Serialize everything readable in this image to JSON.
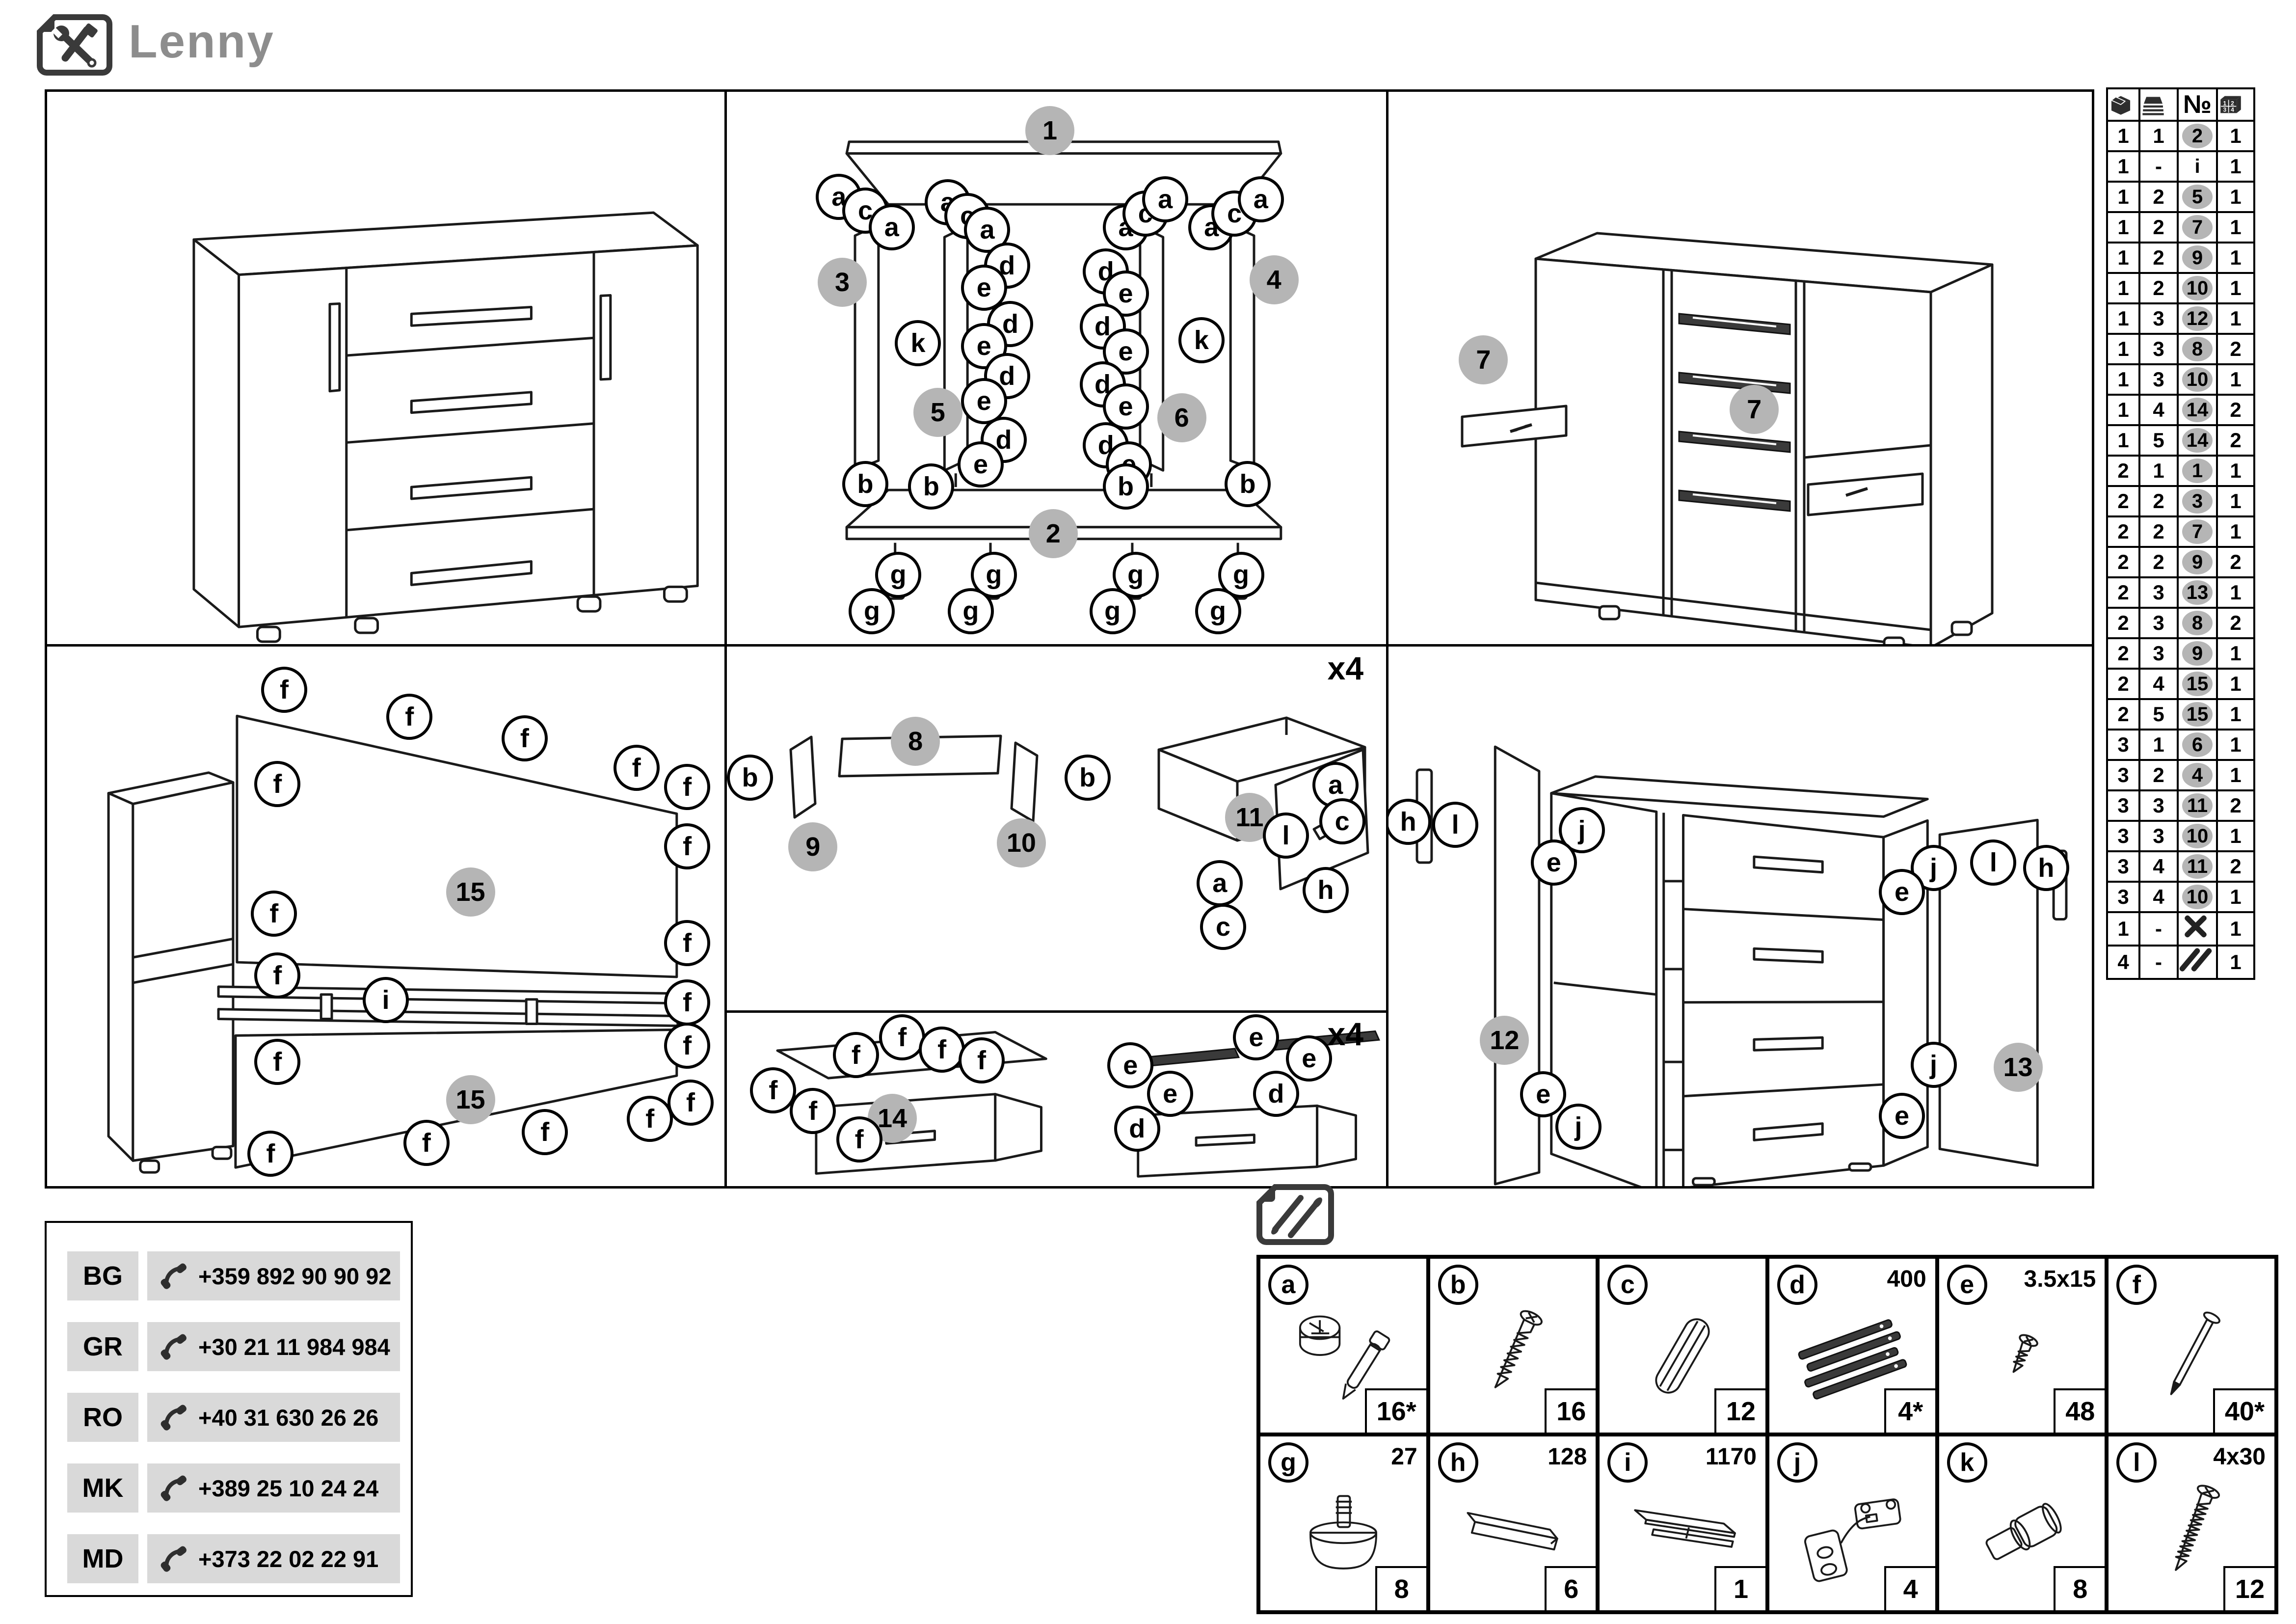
{
  "title": "Lenny",
  "colors": {
    "step_circle": "#b5b5b5",
    "title_gray": "#8d8d8d",
    "phone_bg": "#d9d9d9",
    "ink": "#1a1a1a"
  },
  "parts_table": {
    "number_header": "№",
    "header_icons": [
      "package-icon",
      "sheets-icon",
      "number-header",
      "carton-icon"
    ],
    "rows": [
      {
        "box": "1",
        "sheet": "1",
        "num": "2",
        "numstyle": "circled",
        "qty": "1"
      },
      {
        "box": "1",
        "sheet": "-",
        "num": "i",
        "numstyle": "plain",
        "qty": "1"
      },
      {
        "box": "1",
        "sheet": "2",
        "num": "5",
        "numstyle": "circled",
        "qty": "1"
      },
      {
        "box": "1",
        "sheet": "2",
        "num": "7",
        "numstyle": "circled",
        "qty": "1"
      },
      {
        "box": "1",
        "sheet": "2",
        "num": "9",
        "numstyle": "circled",
        "qty": "1"
      },
      {
        "box": "1",
        "sheet": "2",
        "num": "10",
        "numstyle": "circled",
        "qty": "1"
      },
      {
        "box": "1",
        "sheet": "3",
        "num": "12",
        "numstyle": "circled",
        "qty": "1"
      },
      {
        "box": "1",
        "sheet": "3",
        "num": "8",
        "numstyle": "circled",
        "qty": "2"
      },
      {
        "box": "1",
        "sheet": "3",
        "num": "10",
        "numstyle": "circled",
        "qty": "1"
      },
      {
        "box": "1",
        "sheet": "4",
        "num": "14",
        "numstyle": "circled",
        "qty": "2"
      },
      {
        "box": "1",
        "sheet": "5",
        "num": "14",
        "numstyle": "circled",
        "qty": "2"
      },
      {
        "box": "2",
        "sheet": "1",
        "num": "1",
        "numstyle": "circled",
        "qty": "1"
      },
      {
        "box": "2",
        "sheet": "2",
        "num": "3",
        "numstyle": "circled",
        "qty": "1"
      },
      {
        "box": "2",
        "sheet": "2",
        "num": "7",
        "numstyle": "circled",
        "qty": "1"
      },
      {
        "box": "2",
        "sheet": "2",
        "num": "9",
        "numstyle": "circled",
        "qty": "2"
      },
      {
        "box": "2",
        "sheet": "3",
        "num": "13",
        "numstyle": "circled",
        "qty": "1"
      },
      {
        "box": "2",
        "sheet": "3",
        "num": "8",
        "numstyle": "circled",
        "qty": "2"
      },
      {
        "box": "2",
        "sheet": "3",
        "num": "9",
        "numstyle": "circled",
        "qty": "1"
      },
      {
        "box": "2",
        "sheet": "4",
        "num": "15",
        "numstyle": "circled",
        "qty": "1"
      },
      {
        "box": "2",
        "sheet": "5",
        "num": "15",
        "numstyle": "circled",
        "qty": "1"
      },
      {
        "box": "3",
        "sheet": "1",
        "num": "6",
        "numstyle": "circled",
        "qty": "1"
      },
      {
        "box": "3",
        "sheet": "2",
        "num": "4",
        "numstyle": "circled",
        "qty": "1"
      },
      {
        "box": "3",
        "sheet": "3",
        "num": "11",
        "numstyle": "circled",
        "qty": "2"
      },
      {
        "box": "3",
        "sheet": "3",
        "num": "10",
        "numstyle": "circled",
        "qty": "1"
      },
      {
        "box": "3",
        "sheet": "4",
        "num": "11",
        "numstyle": "circled",
        "qty": "2"
      },
      {
        "box": "3",
        "sheet": "4",
        "num": "10",
        "numstyle": "circled",
        "qty": "1"
      },
      {
        "box": "1",
        "sheet": "-",
        "num": "",
        "numstyle": "tools",
        "qty": "1"
      },
      {
        "box": "4",
        "sheet": "-",
        "num": "",
        "numstyle": "screws",
        "qty": "1"
      }
    ]
  },
  "phones": {
    "rows": [
      {
        "code": "BG",
        "number": "+359 892 90 90 92"
      },
      {
        "code": "GR",
        "number": "+30 21 11 984 984"
      },
      {
        "code": "RO",
        "number": "+40 31 630 26 26"
      },
      {
        "code": "MK",
        "number": "+389 25 10 24 24"
      },
      {
        "code": "MD",
        "number": "+373 22 02 22 91"
      }
    ]
  },
  "hardware": {
    "cells": [
      {
        "letter": "a",
        "spec": "",
        "qty": "16*",
        "icon": "cam-lock-icon"
      },
      {
        "letter": "b",
        "spec": "",
        "qty": "16",
        "icon": "screw-icon"
      },
      {
        "letter": "c",
        "spec": "",
        "qty": "12",
        "icon": "dowel-icon"
      },
      {
        "letter": "d",
        "spec": "400",
        "qty": "4*",
        "icon": "drawer-slides-icon"
      },
      {
        "letter": "e",
        "spec": "3.5x15",
        "qty": "48",
        "icon": "small-screw-icon"
      },
      {
        "letter": "f",
        "spec": "",
        "qty": "40*",
        "icon": "nail-icon"
      },
      {
        "letter": "g",
        "spec": "27",
        "qty": "8",
        "icon": "foot-icon"
      },
      {
        "letter": "h",
        "spec": "128",
        "qty": "6",
        "icon": "profile-strip-icon"
      },
      {
        "letter": "i",
        "spec": "1170",
        "qty": "1",
        "icon": "h-profile-icon"
      },
      {
        "letter": "j",
        "spec": "",
        "qty": "4",
        "icon": "hinge-icon"
      },
      {
        "letter": "k",
        "spec": "",
        "qty": "8",
        "icon": "shelf-pin-icon"
      },
      {
        "letter": "l",
        "spec": "4x30",
        "qty": "12",
        "icon": "long-screw-icon"
      }
    ]
  },
  "panels": {
    "assembled": {
      "callouts": []
    },
    "exploded": {
      "callouts": [
        {
          "t": "step",
          "label": "1",
          "x": 49,
          "y": 7
        },
        {
          "t": "step",
          "label": "2",
          "x": 49.5,
          "y": 80
        },
        {
          "t": "step",
          "label": "3",
          "x": 17.5,
          "y": 34.5
        },
        {
          "t": "step",
          "label": "4",
          "x": 83,
          "y": 34
        },
        {
          "t": "step",
          "label": "5",
          "x": 32,
          "y": 58
        },
        {
          "t": "step",
          "label": "6",
          "x": 69,
          "y": 59
        },
        {
          "t": "part",
          "label": "a",
          "x": 17,
          "y": 19
        },
        {
          "t": "part",
          "label": "c",
          "x": 21,
          "y": 21.5
        },
        {
          "t": "part",
          "label": "a",
          "x": 25,
          "y": 24.5
        },
        {
          "t": "part",
          "label": "a",
          "x": 33.5,
          "y": 20
        },
        {
          "t": "part",
          "label": "c",
          "x": 36.5,
          "y": 22.5
        },
        {
          "t": "part",
          "label": "a",
          "x": 39.5,
          "y": 25
        },
        {
          "t": "part",
          "label": "a",
          "x": 60.5,
          "y": 24.5
        },
        {
          "t": "part",
          "label": "c",
          "x": 63.5,
          "y": 22
        },
        {
          "t": "part",
          "label": "a",
          "x": 66.5,
          "y": 19.5
        },
        {
          "t": "part",
          "label": "a",
          "x": 73.5,
          "y": 24.5
        },
        {
          "t": "part",
          "label": "c",
          "x": 77,
          "y": 22
        },
        {
          "t": "part",
          "label": "a",
          "x": 81,
          "y": 19.5
        },
        {
          "t": "part",
          "label": "d",
          "x": 42.5,
          "y": 31.5
        },
        {
          "t": "part",
          "label": "e",
          "x": 39,
          "y": 35.5
        },
        {
          "t": "part",
          "label": "d",
          "x": 43,
          "y": 42
        },
        {
          "t": "part",
          "label": "e",
          "x": 39,
          "y": 46
        },
        {
          "t": "part",
          "label": "d",
          "x": 42.5,
          "y": 51.5
        },
        {
          "t": "part",
          "label": "e",
          "x": 39,
          "y": 56
        },
        {
          "t": "part",
          "label": "d",
          "x": 42,
          "y": 63
        },
        {
          "t": "part",
          "label": "e",
          "x": 38.5,
          "y": 67.5
        },
        {
          "t": "part",
          "label": "d",
          "x": 57.5,
          "y": 32.5
        },
        {
          "t": "part",
          "label": "e",
          "x": 60.5,
          "y": 36.5
        },
        {
          "t": "part",
          "label": "d",
          "x": 57,
          "y": 42.5
        },
        {
          "t": "part",
          "label": "e",
          "x": 60.5,
          "y": 47
        },
        {
          "t": "part",
          "label": "d",
          "x": 57,
          "y": 53
        },
        {
          "t": "part",
          "label": "e",
          "x": 60.5,
          "y": 57
        },
        {
          "t": "part",
          "label": "d",
          "x": 57.5,
          "y": 64
        },
        {
          "t": "part",
          "label": "e",
          "x": 61,
          "y": 67.5
        },
        {
          "t": "part",
          "label": "k",
          "x": 29,
          "y": 45.5
        },
        {
          "t": "part",
          "label": "k",
          "x": 72,
          "y": 45
        },
        {
          "t": "part",
          "label": "b",
          "x": 21,
          "y": 71
        },
        {
          "t": "part",
          "label": "b",
          "x": 31,
          "y": 71.5
        },
        {
          "t": "part",
          "label": "b",
          "x": 60.5,
          "y": 71.5
        },
        {
          "t": "part",
          "label": "b",
          "x": 79,
          "y": 71
        },
        {
          "t": "part",
          "label": "g",
          "x": 26,
          "y": 87.5
        },
        {
          "t": "part",
          "label": "g",
          "x": 22,
          "y": 94
        },
        {
          "t": "part",
          "label": "g",
          "x": 40.5,
          "y": 87.5
        },
        {
          "t": "part",
          "label": "g",
          "x": 37,
          "y": 94
        },
        {
          "t": "part",
          "label": "g",
          "x": 62,
          "y": 87.5
        },
        {
          "t": "part",
          "label": "g",
          "x": 58.5,
          "y": 94
        },
        {
          "t": "part",
          "label": "g",
          "x": 78,
          "y": 87.5
        },
        {
          "t": "part",
          "label": "g",
          "x": 74.5,
          "y": 94
        }
      ]
    },
    "carcass": {
      "callouts": [
        {
          "t": "step",
          "label": "7",
          "x": 13.5,
          "y": 48.5
        },
        {
          "t": "step",
          "label": "7",
          "x": 52,
          "y": 57.5
        }
      ]
    },
    "back": {
      "callouts": [
        {
          "t": "step",
          "label": "15",
          "x": 62.5,
          "y": 45.5
        },
        {
          "t": "step",
          "label": "15",
          "x": 62.5,
          "y": 84
        },
        {
          "t": "part",
          "label": "i",
          "x": 50,
          "y": 65.5
        },
        {
          "t": "part",
          "label": "f",
          "x": 35,
          "y": 8
        },
        {
          "t": "part",
          "label": "f",
          "x": 53.5,
          "y": 13
        },
        {
          "t": "part",
          "label": "f",
          "x": 70.5,
          "y": 17
        },
        {
          "t": "part",
          "label": "f",
          "x": 87,
          "y": 22.5
        },
        {
          "t": "part",
          "label": "f",
          "x": 94.5,
          "y": 26
        },
        {
          "t": "part",
          "label": "f",
          "x": 34,
          "y": 25.5
        },
        {
          "t": "part",
          "label": "f",
          "x": 33.5,
          "y": 49.5
        },
        {
          "t": "part",
          "label": "f",
          "x": 94.5,
          "y": 37
        },
        {
          "t": "part",
          "label": "f",
          "x": 94.5,
          "y": 55
        },
        {
          "t": "part",
          "label": "f",
          "x": 34,
          "y": 61
        },
        {
          "t": "part",
          "label": "f",
          "x": 34,
          "y": 77
        },
        {
          "t": "part",
          "label": "f",
          "x": 94.5,
          "y": 66
        },
        {
          "t": "part",
          "label": "f",
          "x": 94.5,
          "y": 74
        },
        {
          "t": "part",
          "label": "f",
          "x": 33,
          "y": 94
        },
        {
          "t": "part",
          "label": "f",
          "x": 56,
          "y": 92
        },
        {
          "t": "part",
          "label": "f",
          "x": 73.5,
          "y": 90
        },
        {
          "t": "part",
          "label": "f",
          "x": 89,
          "y": 87.5
        },
        {
          "t": "part",
          "label": "f",
          "x": 95,
          "y": 84.5
        }
      ]
    },
    "drawer_parts": {
      "callouts": [
        {
          "t": "txt",
          "label": "x4",
          "x": 93.5,
          "y": 6
        },
        {
          "t": "step",
          "label": "9",
          "x": 13,
          "y": 55
        },
        {
          "t": "step",
          "label": "8",
          "x": 28.5,
          "y": 26
        },
        {
          "t": "step",
          "label": "10",
          "x": 44.5,
          "y": 54
        },
        {
          "t": "step",
          "label": "11",
          "x": 79,
          "y": 47
        },
        {
          "t": "part",
          "label": "b",
          "x": 3.5,
          "y": 36
        },
        {
          "t": "part",
          "label": "b",
          "x": 54.5,
          "y": 36
        },
        {
          "t": "part",
          "label": "a",
          "x": 92,
          "y": 38
        },
        {
          "t": "part",
          "label": "c",
          "x": 93,
          "y": 48
        },
        {
          "t": "part",
          "label": "l",
          "x": 84.5,
          "y": 52
        },
        {
          "t": "part",
          "label": "a",
          "x": 74.5,
          "y": 65
        },
        {
          "t": "part",
          "label": "h",
          "x": 90.5,
          "y": 67
        },
        {
          "t": "part",
          "label": "c",
          "x": 75,
          "y": 77
        }
      ]
    },
    "drawer_bottom": {
      "callouts": [
        {
          "t": "txt",
          "label": "x4",
          "x": 93.5,
          "y": 12
        },
        {
          "t": "step",
          "label": "14",
          "x": 25,
          "y": 60
        },
        {
          "t": "part",
          "label": "f",
          "x": 7,
          "y": 44
        },
        {
          "t": "part",
          "label": "f",
          "x": 13,
          "y": 56
        },
        {
          "t": "part",
          "label": "f",
          "x": 19.5,
          "y": 24
        },
        {
          "t": "part",
          "label": "f",
          "x": 20,
          "y": 72
        },
        {
          "t": "part",
          "label": "f",
          "x": 26.5,
          "y": 14
        },
        {
          "t": "part",
          "label": "f",
          "x": 32.5,
          "y": 21
        },
        {
          "t": "part",
          "label": "f",
          "x": 38.5,
          "y": 27
        },
        {
          "t": "part",
          "label": "e",
          "x": 61,
          "y": 30
        },
        {
          "t": "part",
          "label": "e",
          "x": 67,
          "y": 46
        },
        {
          "t": "part",
          "label": "d",
          "x": 62,
          "y": 66
        },
        {
          "t": "part",
          "label": "e",
          "x": 80,
          "y": 14
        },
        {
          "t": "part",
          "label": "e",
          "x": 88,
          "y": 26
        },
        {
          "t": "part",
          "label": "d",
          "x": 83,
          "y": 46
        }
      ]
    },
    "doors": {
      "callouts": [
        {
          "t": "step",
          "label": "12",
          "x": 16.5,
          "y": 73
        },
        {
          "t": "step",
          "label": "13",
          "x": 89.5,
          "y": 78
        },
        {
          "t": "part",
          "label": "h",
          "x": 2.8,
          "y": 32.5
        },
        {
          "t": "part",
          "label": "l",
          "x": 9.5,
          "y": 33
        },
        {
          "t": "part",
          "label": "j",
          "x": 27.5,
          "y": 34
        },
        {
          "t": "part",
          "label": "e",
          "x": 23.5,
          "y": 40
        },
        {
          "t": "part",
          "label": "e",
          "x": 22,
          "y": 83
        },
        {
          "t": "part",
          "label": "j",
          "x": 27,
          "y": 89
        },
        {
          "t": "part",
          "label": "j",
          "x": 77.5,
          "y": 41
        },
        {
          "t": "part",
          "label": "e",
          "x": 73,
          "y": 45.5
        },
        {
          "t": "part",
          "label": "j",
          "x": 77.5,
          "y": 77.5
        },
        {
          "t": "part",
          "label": "e",
          "x": 73,
          "y": 87
        },
        {
          "t": "part",
          "label": "l",
          "x": 86,
          "y": 40
        },
        {
          "t": "part",
          "label": "h",
          "x": 93.5,
          "y": 41
        }
      ]
    }
  }
}
